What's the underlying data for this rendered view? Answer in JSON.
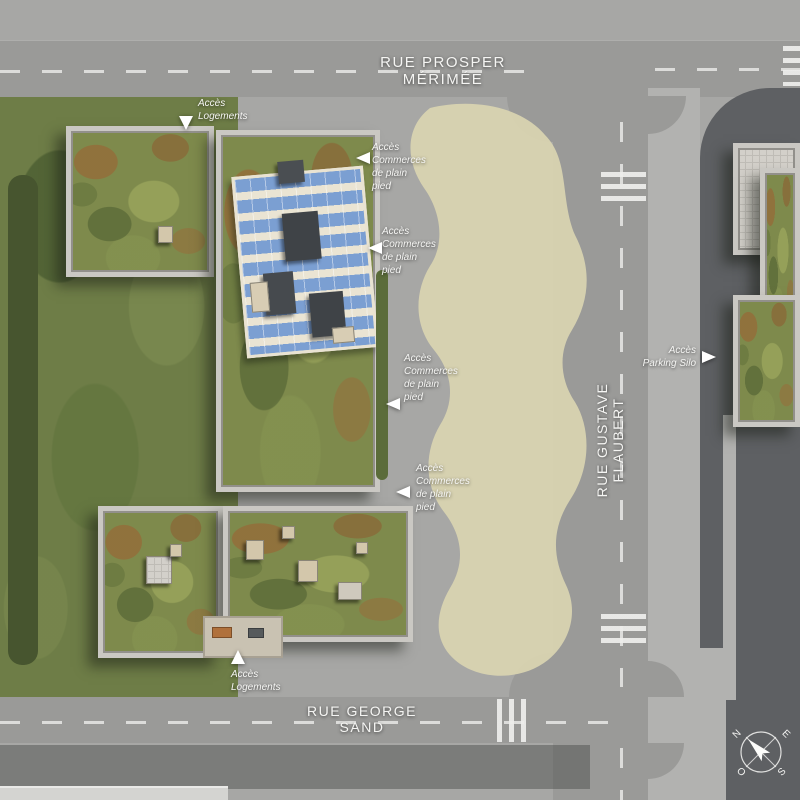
{
  "scene": {
    "description": "Aerial architectural site plan of an urban block: green-roof residential buildings, rooftop solar array, central planted plaza, tree-lined streets and parking silo"
  },
  "streets": {
    "top": "RUE PROSPER MÉRIMÉE",
    "right": "RUE GUSTAVE FLAUBERT",
    "bottom": "RUE GEORGE SAND"
  },
  "annotations": {
    "acces_logements": "Accès\nLogements",
    "acces_commerces": "Accès\nCommerces\nde plain\npied",
    "acces_parking_silo": "Accès\nParking Silo"
  },
  "compass": {
    "north": "N",
    "east": "E",
    "south": "S",
    "west": "O"
  },
  "icons": {
    "wheelchair": "♿"
  },
  "colors": {
    "plaza": "#a7a7a5",
    "road": "#9a9a98",
    "sidewalk": "#b2b2b0",
    "dark_asphalt": "#5e6063",
    "park_green": "#6e7d47",
    "sedum_green": "#7e8a4c",
    "gravel": "#d8d3b0",
    "solar_blue": "#7b9fd2",
    "frame": "#cac8c3",
    "hedge": "#47552f",
    "handicap_blue": "#4a6d95",
    "marking_white": "#e8e8e6"
  }
}
